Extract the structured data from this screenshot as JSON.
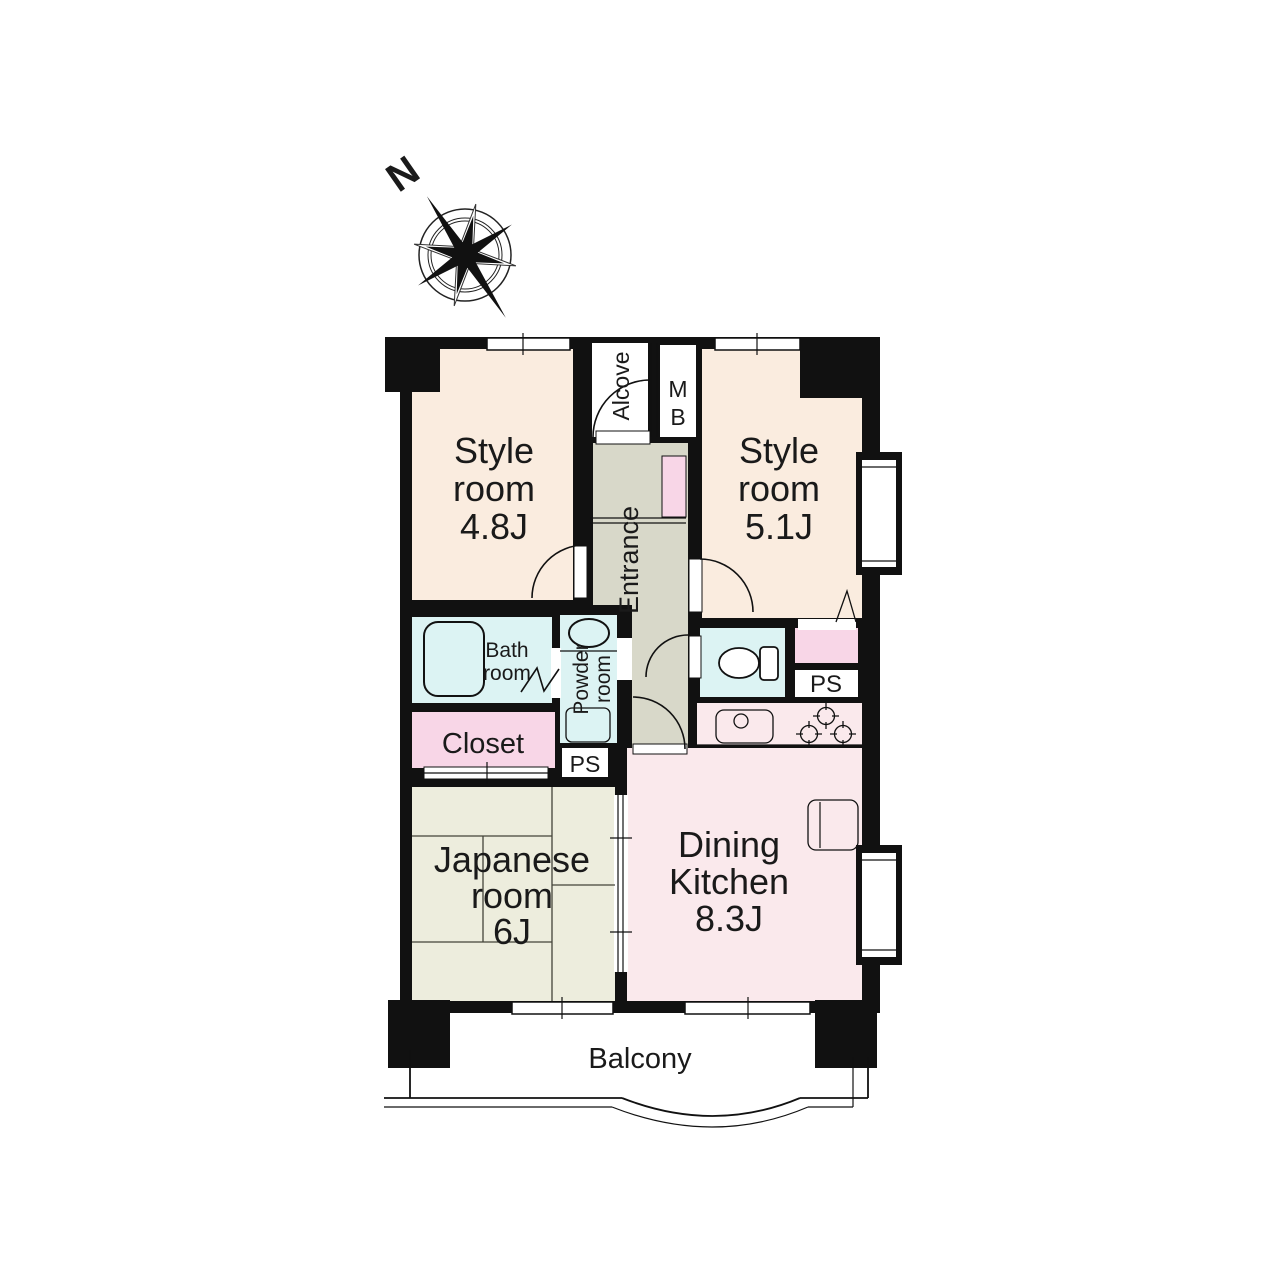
{
  "compass": {
    "north_label": "N"
  },
  "rooms": {
    "style_room_1": {
      "line1": "Style",
      "line2": "room",
      "size": "4.8J"
    },
    "style_room_2": {
      "line1": "Style",
      "line2": "room",
      "size": "5.1J"
    },
    "japanese_room": {
      "line1": "Japanese",
      "line2": "room",
      "size": "6J"
    },
    "dining_kitchen": {
      "line1": "Dining",
      "line2": "Kitchen",
      "size": "8.3J"
    },
    "closet": {
      "label": "Closet"
    },
    "bath_room": {
      "line1": "Bath",
      "line2": "room"
    },
    "powder_room": {
      "line1": "Powder",
      "line2": "room"
    },
    "entrance": {
      "label": "Entrance"
    },
    "alcove": {
      "label": "Alcove"
    },
    "meter_box": {
      "line1": "M",
      "line2": "B"
    },
    "pipe_space_left": {
      "label": "PS"
    },
    "pipe_space_right": {
      "label": "PS"
    },
    "balcony": {
      "label": "Balcony"
    }
  },
  "colors": {
    "wall": "#111111",
    "western_room": "#FAECDF",
    "entrance_hall": "#D8D8C9",
    "wet_area": "#DCF3F3",
    "storage": "#F8D6E7",
    "dining_kitchen": "#FAE9EC",
    "tatami": "#EDEDDD",
    "background": "#FFFFFF"
  }
}
